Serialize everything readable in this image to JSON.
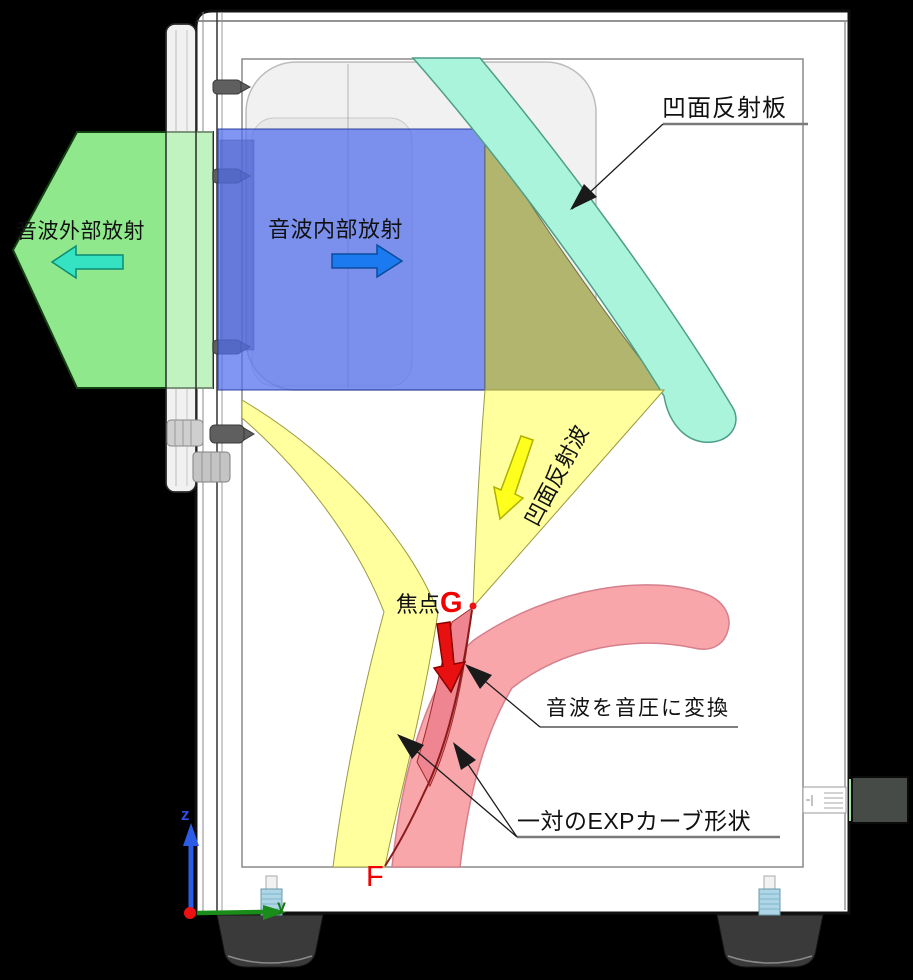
{
  "diagram": {
    "description_labels": {
      "reflector": "凹面反射板",
      "external_radiation": "音波外部放射",
      "internal_radiation": "音波内部放射",
      "reflected_wave": "凹面反射波",
      "focal_prefix": "焦点",
      "focal_letter": "G",
      "convert": "音波を音圧に変換",
      "exp_curves": "一対のEXPカーブ形状",
      "mouth_letter": "F",
      "axis_z": "z",
      "axis_y": "y"
    },
    "colors": {
      "background": "#000000",
      "cabinet": "#ffffff",
      "external_region": "#8fe98c",
      "external_arrow": "#35e3c3",
      "internal_region": "#7b9af0",
      "internal_arrow": "#1b7af0",
      "reflector_band": "#a9f4db",
      "overlap_region": "#b2b56e",
      "reflected_region": "#ffff9e",
      "reflected_arrow": "#ffff1e",
      "exp_band": "#f8a6aa",
      "throat_region": "#ee8591",
      "focus_red": "#ee1111"
    }
  }
}
